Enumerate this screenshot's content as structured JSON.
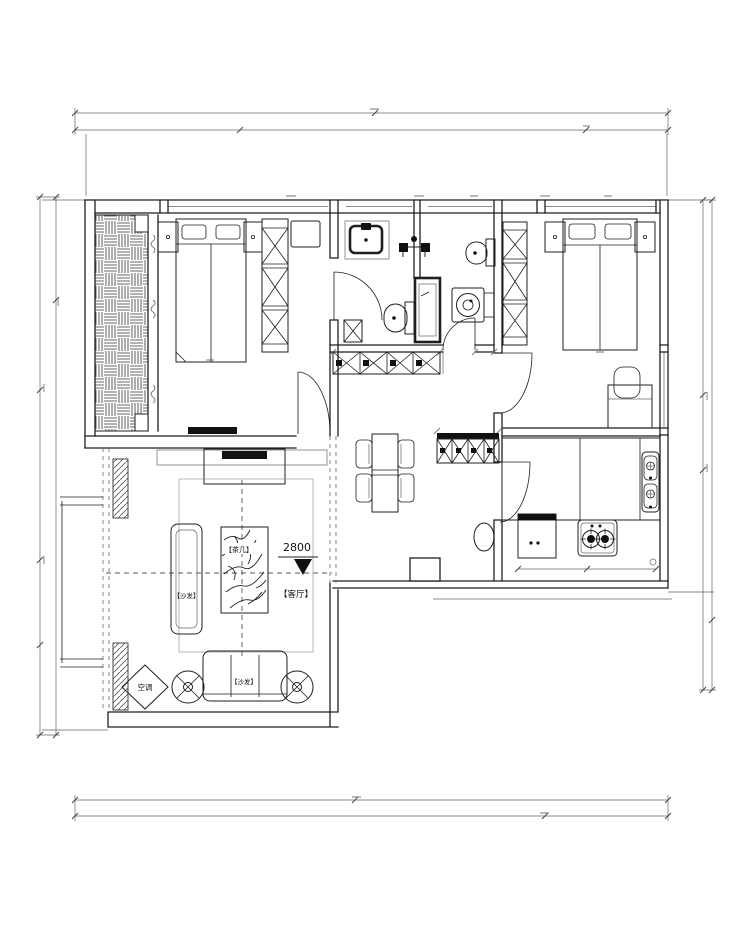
{
  "colors": {
    "line": "#1f1f1f",
    "line_light": "#666666",
    "ink": "#111111",
    "bg": "#ffffff"
  },
  "labels": {
    "tea_table": "【茶几】",
    "sofa_left": "【沙发】",
    "sofa_bottom": "【沙发】",
    "living_room": "【客厅】",
    "air_conditioner": "空调",
    "level_value": "2800"
  }
}
